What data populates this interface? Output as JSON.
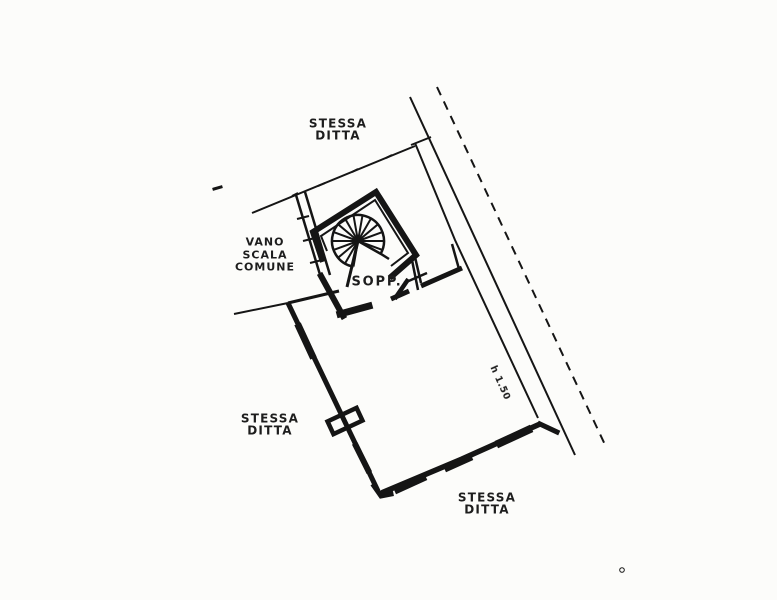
{
  "palette": {
    "background": "#fcfcfa",
    "ink": "#1d1d1d"
  },
  "annotations": {
    "neighbor_top": {
      "line1": "STESSA",
      "line2": "DITTA"
    },
    "neighbor_left": {
      "line1": "STESSA",
      "line2": "DITTA"
    },
    "neighbor_bottom": {
      "line1": "STESSA",
      "line2": "DITTA"
    },
    "common_stairwell": {
      "line1": "VANO",
      "line2": "SCALA",
      "line3": "COMUNE"
    },
    "mezzanine_note": "SOPP.",
    "height_note": "h 1.50"
  },
  "symbols": {
    "spiral_staircase": "spiral-staircase-symbol",
    "window_cross": "window-cross-symbol",
    "door_leaf": "door-leaf-symbol"
  }
}
